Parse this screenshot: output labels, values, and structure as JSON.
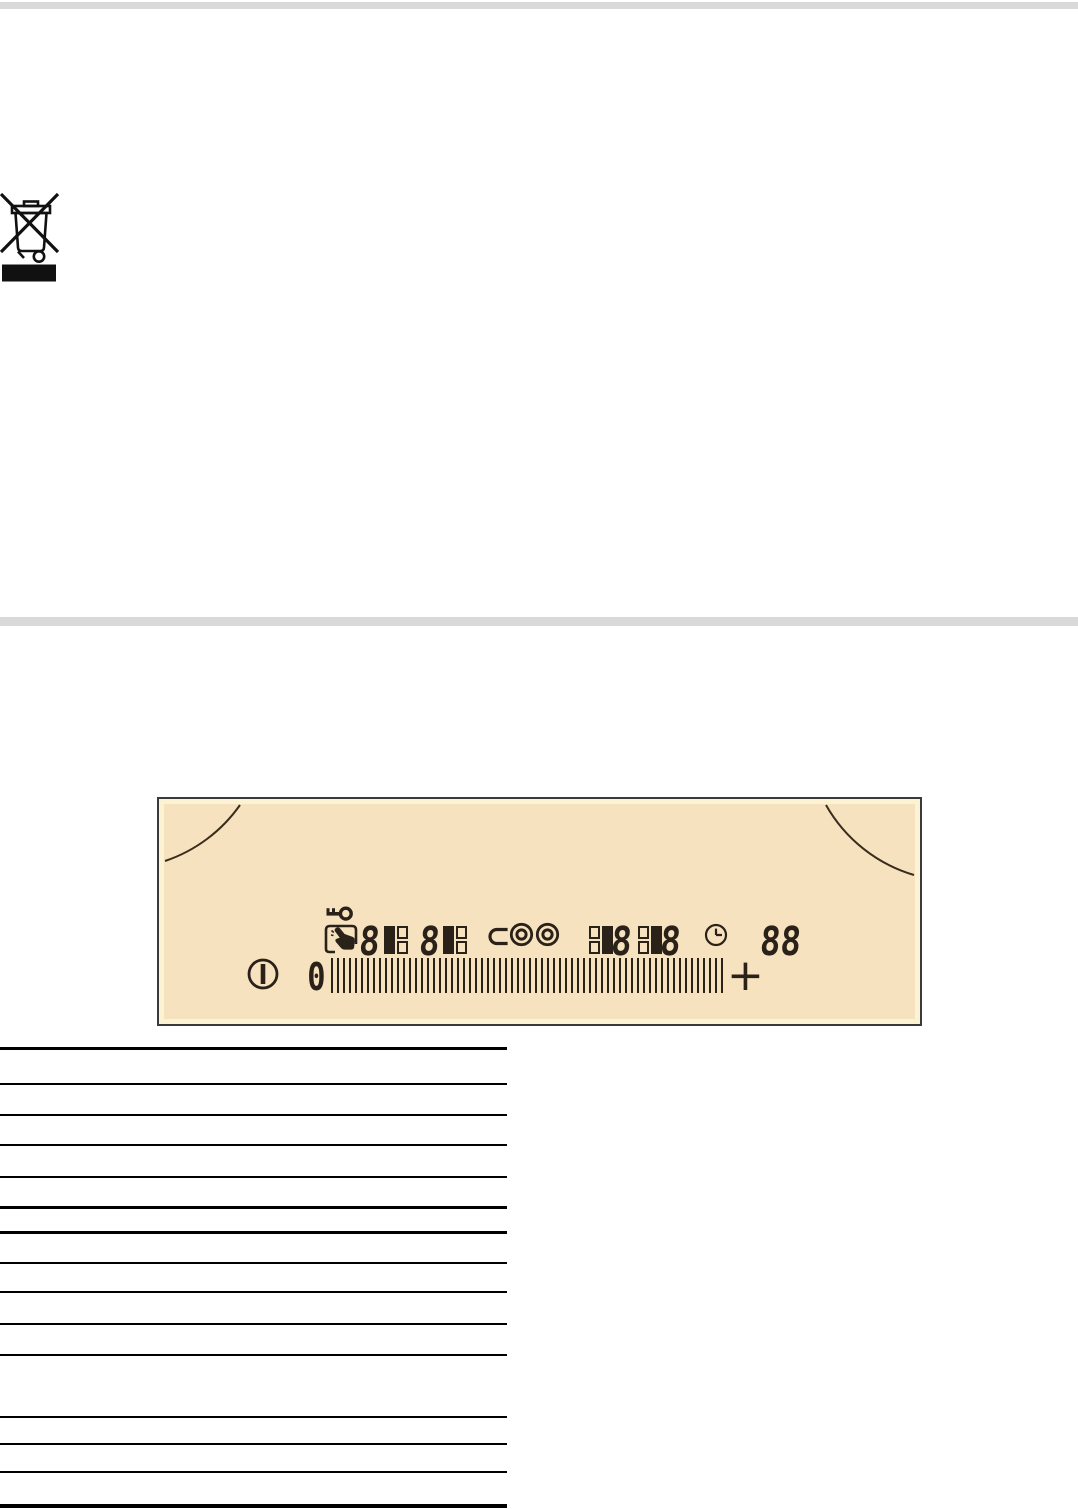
{
  "colors": {
    "page_bg": "#ffffff",
    "rule_gray": "#d9d9d9",
    "table_line": "#000000",
    "panel_fill": "#f6e2bf",
    "panel_trim": "#fbf3d3",
    "panel_border": "#3a3a3a",
    "ink": "#2a2118"
  },
  "weee_symbol": {
    "icon": "crossed-out-wheelie-bin-icon",
    "bar": "solid-black-date-bar"
  },
  "control_panel": {
    "icons": {
      "key": "key-lock-icon",
      "hand": "touch-control-icon",
      "oval_zone": "extension-zone-icon",
      "double_ring_a": "double-ring-zone-icon",
      "double_ring_b": "double-ring-zone-icon",
      "clock": "timer-clock-icon",
      "power": "on-off-icon",
      "arcs": "cooking-zone-arcs"
    },
    "displays": {
      "zone1_digit": "8",
      "zone2_digit": "8",
      "zone3_digit": "8",
      "zone4_digit": "8",
      "timer": "88"
    },
    "slider": {
      "min_label": "0",
      "plus_label": "+"
    }
  },
  "table": {
    "rule_count": 15,
    "visible_text": ""
  }
}
